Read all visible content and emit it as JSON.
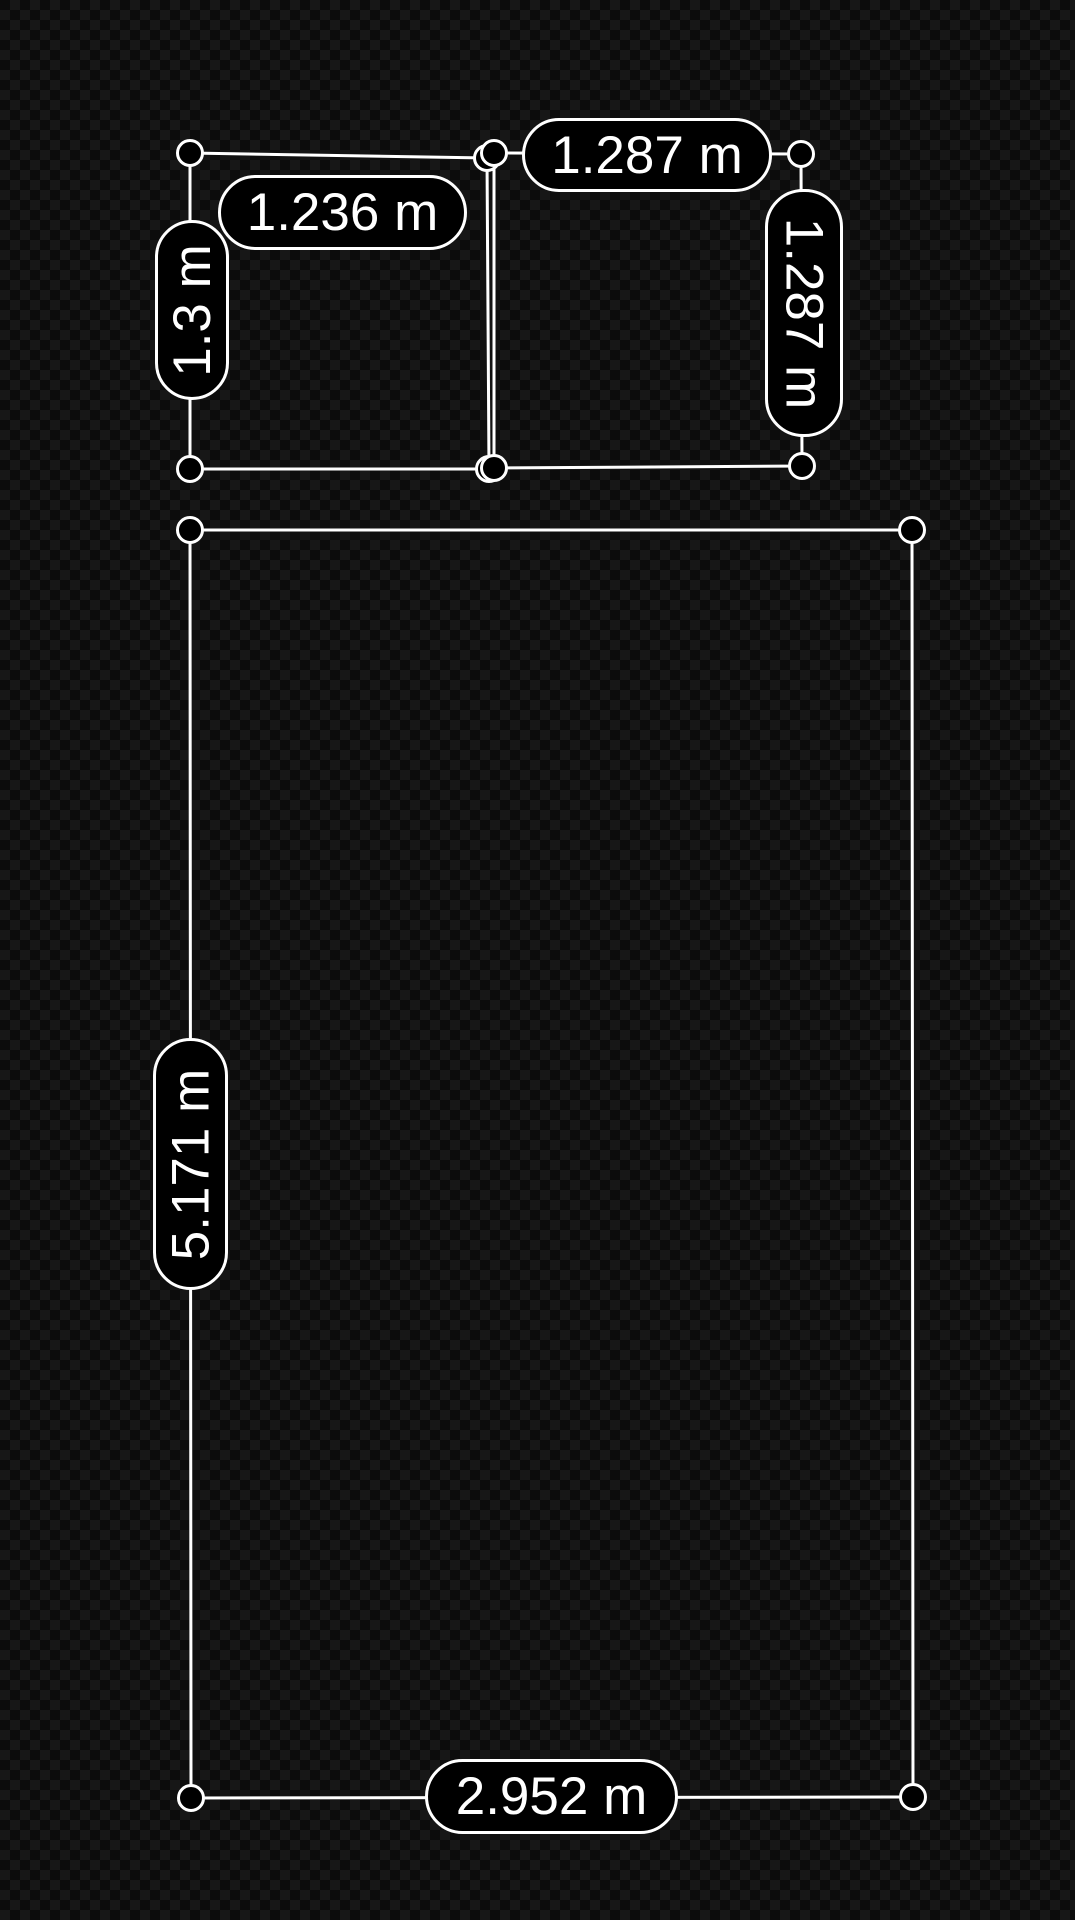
{
  "app": {
    "description": "AR measurement overlay on dark checkerboard background",
    "units": "m"
  },
  "colors": {
    "background_dark": "#0c0c0c",
    "background_light": "#171717",
    "line": "#ffffff",
    "pill_background": "#000000",
    "pill_border": "#ffffff",
    "pill_text": "#ffffff"
  },
  "geometry": {
    "line_width": 3,
    "handle_radius": 12.5,
    "quads": [
      {
        "name": "room-top-left",
        "corners": [
          [
            190,
            153
          ],
          [
            487,
            158
          ],
          [
            489,
            469
          ],
          [
            190,
            469
          ]
        ]
      },
      {
        "name": "room-top-right",
        "corners": [
          [
            494,
            153
          ],
          [
            801,
            154
          ],
          [
            802,
            466
          ],
          [
            494,
            468
          ]
        ]
      },
      {
        "name": "room-main",
        "corners": [
          [
            190,
            530
          ],
          [
            912,
            530
          ],
          [
            913,
            1797
          ],
          [
            191,
            1798
          ]
        ]
      }
    ]
  },
  "labels": [
    {
      "id": "measurement-label-1-236",
      "text": "1.236 m",
      "x": 218,
      "y": 175,
      "w": 249,
      "h": 75,
      "orientation": "horizontal"
    },
    {
      "id": "measurement-label-1-3",
      "text": "1.3 m",
      "x": 155,
      "y": 220,
      "w": 74,
      "h": 180,
      "orientation": "vertical-up"
    },
    {
      "id": "measurement-label-1-287-top",
      "text": "1.287 m",
      "x": 522,
      "y": 118,
      "w": 250,
      "h": 74,
      "orientation": "horizontal"
    },
    {
      "id": "measurement-label-1-287-right",
      "text": "1.287 m",
      "x": 765,
      "y": 189,
      "w": 78,
      "h": 248,
      "orientation": "vertical-down"
    },
    {
      "id": "measurement-label-5-171",
      "text": "5.171 m",
      "x": 153,
      "y": 1038,
      "w": 75,
      "h": 252,
      "orientation": "vertical-up"
    },
    {
      "id": "measurement-label-2-952",
      "text": "2.952 m",
      "x": 425,
      "y": 1759,
      "w": 253,
      "h": 75,
      "orientation": "horizontal"
    }
  ]
}
